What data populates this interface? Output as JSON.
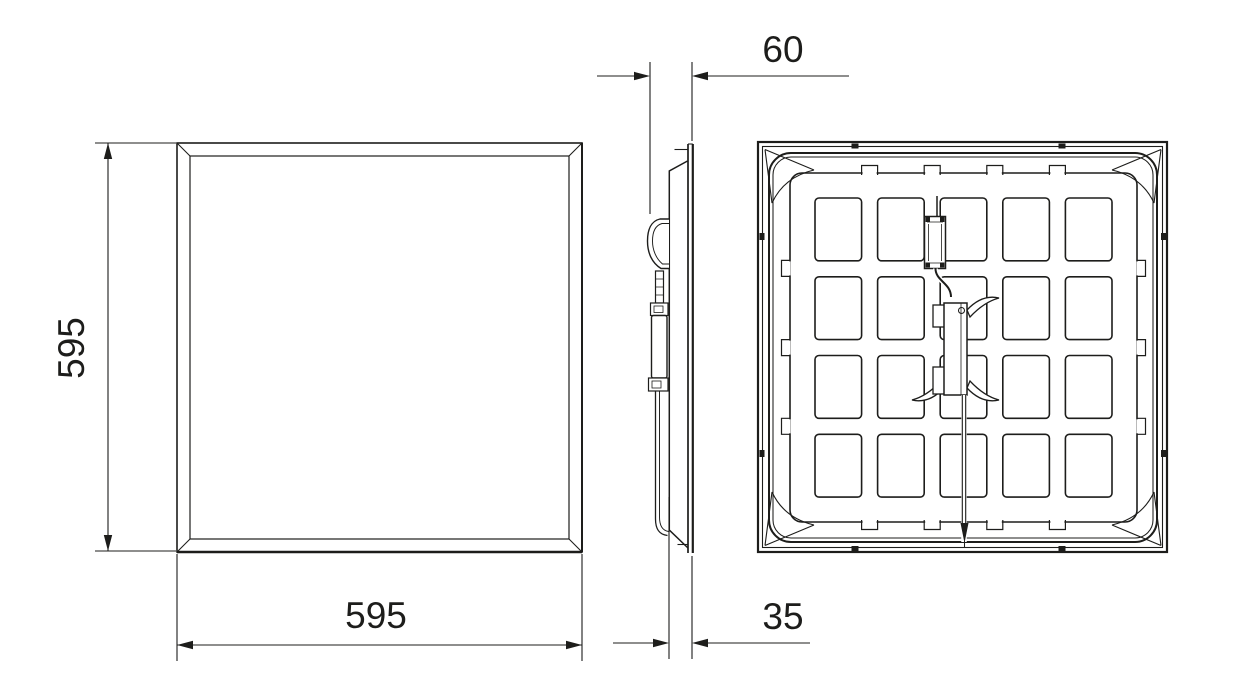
{
  "drawing": {
    "front_view": {
      "height_label": "595",
      "width_label": "595"
    },
    "side_view": {
      "depth_overall_label": "60",
      "depth_recess_label": "35"
    }
  },
  "colors": {
    "line": "#1d1d1b",
    "background": "#ffffff"
  }
}
